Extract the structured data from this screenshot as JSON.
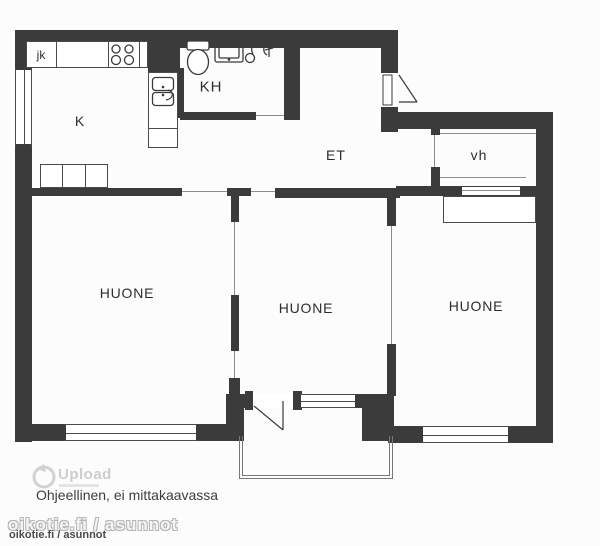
{
  "floorplan": {
    "rooms": {
      "fridge": "jk",
      "kitchen": "K",
      "bathroom": "KH",
      "hall": "ET",
      "closet": "vh",
      "room1": "HUONE",
      "room2": "HUONE",
      "room3": "HUONE"
    },
    "note": "Ohjeellinen, ei mittakaavassa",
    "watermark": {
      "logo_text": "Upload",
      "footer_outline": "oikotie.fi / asunnot",
      "footer_small": "oikotie.fi / asunnot"
    },
    "colors": {
      "wall": "#3b3b3c",
      "line": "#4b4b4b",
      "background": "#fcfcfc",
      "watermark_gray": "#cdcdcd"
    },
    "icons": {
      "stove": "stove-icon",
      "kitchen_sink": "kitchen-sink-icon",
      "toilet": "toilet-icon",
      "washbasin": "washbasin-icon",
      "shower": "shower-icon",
      "upload_logo": "upload-drop-icon"
    }
  }
}
